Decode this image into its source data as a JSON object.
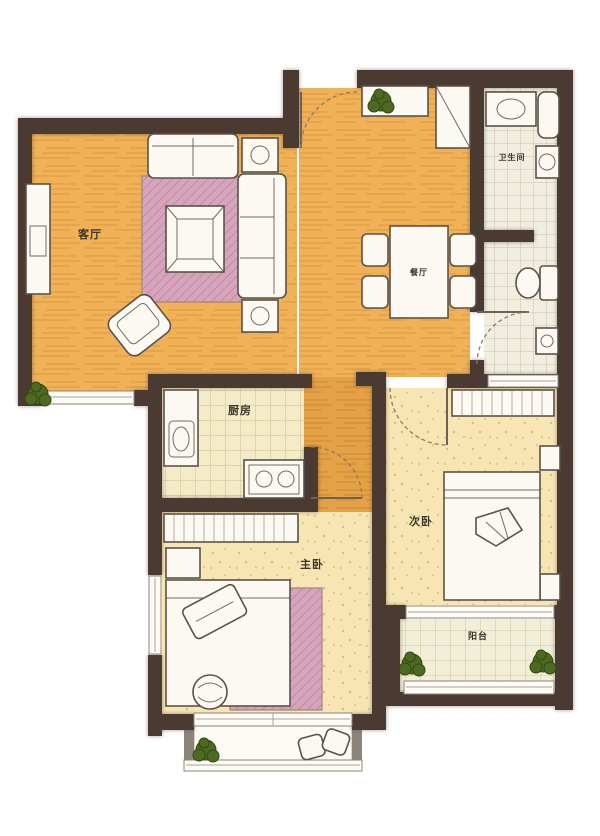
{
  "plan_title": "two-bedroom apartment floor plan",
  "palette": {
    "wall": "#4a3a32",
    "floor_wood": "#f0b157",
    "floor_wood_dark": "#e5a145",
    "floor_pale": "#f7e5b4",
    "tile_kitchen": "#f4ecc8",
    "tile_bath": "#f1eee0",
    "tile_balcony": "#f3eed8",
    "furniture": "#fbf9f2",
    "outline": "#5a5248",
    "rug": "#d6a5bb",
    "rug_dark": "#bd86a5",
    "plant": "#4c6a21",
    "window": "#fcfbf6",
    "label": "#3b352c"
  },
  "rooms": {
    "living": {
      "label": "客厅"
    },
    "dining": {
      "label": "餐厅"
    },
    "kitchen": {
      "label": "厨房"
    },
    "bathroom": {
      "label": "卫生间"
    },
    "master_bedroom": {
      "label": "主卧"
    },
    "second_bedroom": {
      "label": "次卧"
    },
    "balcony": {
      "label": "阳台"
    }
  }
}
